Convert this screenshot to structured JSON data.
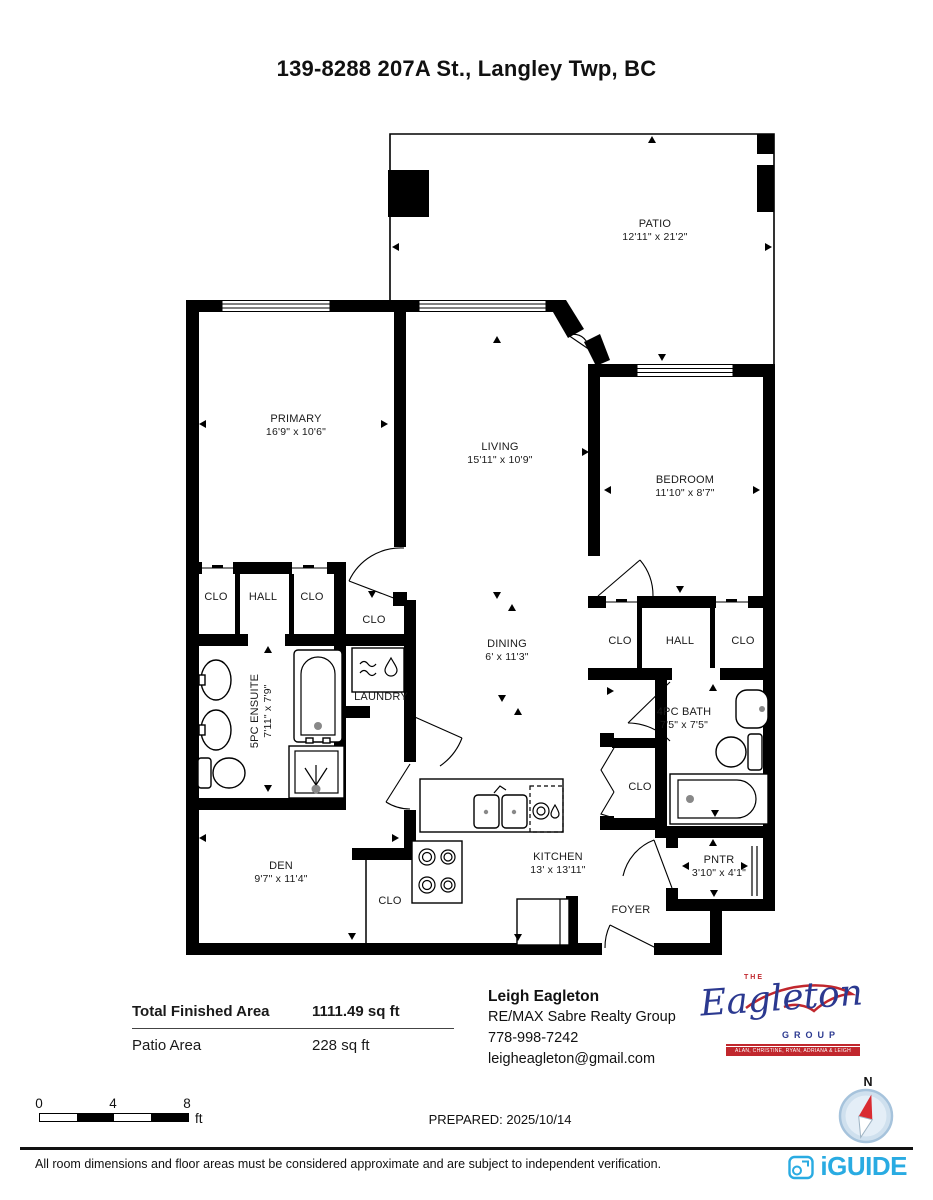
{
  "title": "139-8288 207A St., Langley Twp, BC",
  "rooms": {
    "patio": {
      "name": "PATIO",
      "dims": "12'11\" x 21'2\""
    },
    "primary": {
      "name": "PRIMARY",
      "dims": "16'9\" x 10'6\""
    },
    "living": {
      "name": "LIVING",
      "dims": "15'11\" x 10'9\""
    },
    "bedroom": {
      "name": "BEDROOM",
      "dims": "11'10\" x 8'7\""
    },
    "dining": {
      "name": "DINING",
      "dims": "6' x 11'3\""
    },
    "ensuite": {
      "name": "5PC ENSUITE",
      "dims": "7'11\" x 7'9\""
    },
    "bath": {
      "name": "4PC BATH",
      "dims": "7'5\" x 7'5\""
    },
    "kitchen": {
      "name": "KITCHEN",
      "dims": "13' x 13'11\""
    },
    "den": {
      "name": "DEN",
      "dims": "9'7\" x 11'4\""
    },
    "pantry": {
      "name": "PNTR",
      "dims": "3'10\" x 4'1\""
    },
    "laundry": {
      "name": "LAUNDRY"
    },
    "foyer": {
      "name": "FOYER"
    },
    "hall": {
      "name": "HALL"
    },
    "closet": {
      "name": "CLO"
    }
  },
  "summary": {
    "total_label": "Total Finished Area",
    "total_value": "1111.49 sq ft",
    "patio_label": "Patio Area",
    "patio_value": "228 sq ft"
  },
  "agent": {
    "name": "Leigh Eagleton",
    "company": "RE/MAX Sabre Realty Group",
    "phone": "778-998-7242",
    "email": "leigheagleton@gmail.com"
  },
  "logo": {
    "the": "THE",
    "name": "Eagleton",
    "group": "GROUP",
    "members": "ALAN, CHRISTINE, RYAN, ADRIANA & LEIGH"
  },
  "scale_bar": {
    "ticks": [
      "0",
      "4",
      "8"
    ],
    "unit": "ft"
  },
  "prepared": "PREPARED: 2025/10/14",
  "compass_label": "N",
  "footer": {
    "disclaimer": "All room dimensions and floor areas must be considered approximate and are subject to independent verification.",
    "brand": "iGUIDE"
  },
  "colors": {
    "iguide_blue": "#29abe2",
    "logo_navy": "#2b3990",
    "logo_red": "#c1272d"
  }
}
